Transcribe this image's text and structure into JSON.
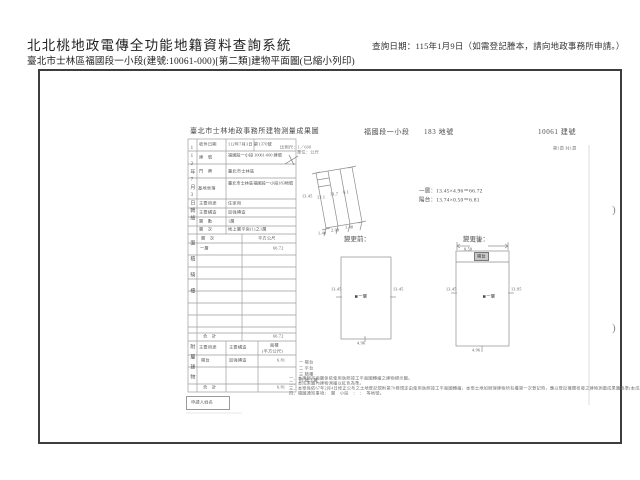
{
  "header": {
    "system_title": "北北桃地政電傳全功能地籍資料查詢系統",
    "query_date": "查詢日期：115年1月9日（如需登記謄本，請向地政事務所申請。）",
    "doc_subtitle": "臺北市士林區福國段一小段(建號:10061-000)[第二類]建物平面圖(已縮小列印)"
  },
  "document": {
    "title": "臺北市士林地政事務所建物測量成果圖",
    "section": "福國段一小段",
    "land_no": "183 地號",
    "building_no": "10061 建號",
    "scale_note": "比例尺：1／600",
    "unit_note": "單位：公尺",
    "page_note": "第1頁 共1頁",
    "form": {
      "strip_top": "112年7月3日轉繪",
      "strip_mid": "面積騎樓",
      "strip_bottom": "附屬建物",
      "rows": [
        {
          "label": "收件日期",
          "value": "112年7月3日 第1370號"
        },
        {
          "label": "建　號",
          "value": "福國段一小段 10061-000 建號"
        },
        {
          "label": "門　牌",
          "value": "臺北市士林區"
        },
        {
          "label": "基地坐落",
          "value": "臺北市士林區福國段一小段183地號"
        },
        {
          "label": "主要用途",
          "value": "住家用"
        },
        {
          "label": "主要構造",
          "value": "加強磚造"
        },
        {
          "label": "層　數",
          "value": "1層"
        },
        {
          "label": "層　次",
          "value": "地上層平房(1)之1層"
        }
      ],
      "area_header_floor": "層　次",
      "area_header_unit": "平方公尺",
      "area_floor": "一層",
      "area_value": "66.72",
      "total_label": "合　計",
      "total_value": "66.72",
      "annex_header_use": "主要用途",
      "annex_header_structure": "主要構造",
      "annex_header_area": "面積",
      "annex_header_area2": "(平方公尺)",
      "annex_use": "陽台",
      "annex_structure": "加強磚造",
      "annex_area": "6.81",
      "annex_total_label": "合　計",
      "annex_total_value": "6.81",
      "applicant_label": "申請人姓名",
      "legend": [
        "一 陽台",
        "二 平台",
        "三 騎樓",
        "四 地下層"
      ]
    },
    "drawing": {
      "calc_line1": "一層：13.45×4.96＝66.72",
      "calc_line2": "陽台：13.74×0.50＝6.81",
      "before_label": "變更前：",
      "after_label": "變更後：",
      "floor_label": "一層",
      "balcony_label": "陽台",
      "plot_dim_left": "13.45",
      "plot_inner1": "13.1",
      "plot_inner2": "13.7",
      "plot_inner3": "6.1",
      "plot_bottom1": "1.40",
      "plot_bottom2": "2.08",
      "plot_bottom3": "1.48",
      "before_dim_left": "13.45",
      "before_dim_right": "13.45",
      "before_dim_bottom": "4.96",
      "after_dim_top": "4.96",
      "after_dim_top2": "0.50",
      "after_dim_left": "13.45",
      "after_dim_right": "13.95",
      "after_dim_bottom": "4.96"
    },
    "footnotes": [
      "一、本建物平面圖係依使用執照竣工平面圖轉繪之建物標示圖。",
      "二、本成果圖內建物測繪以紅色為準。",
      "三、本案係依67年2月4日修正公布之土地登記規則第70條規定由使用執照竣工平面圖轉繪，本案土地如辦理建物所有權第一次登記時，應以登記機關核發之建物測量成果圖為準(本成果圖僅供參考用)。",
      "四、隨圖通知事項：　層　小段　：　：　等地號。"
    ],
    "page_curl": ")"
  }
}
